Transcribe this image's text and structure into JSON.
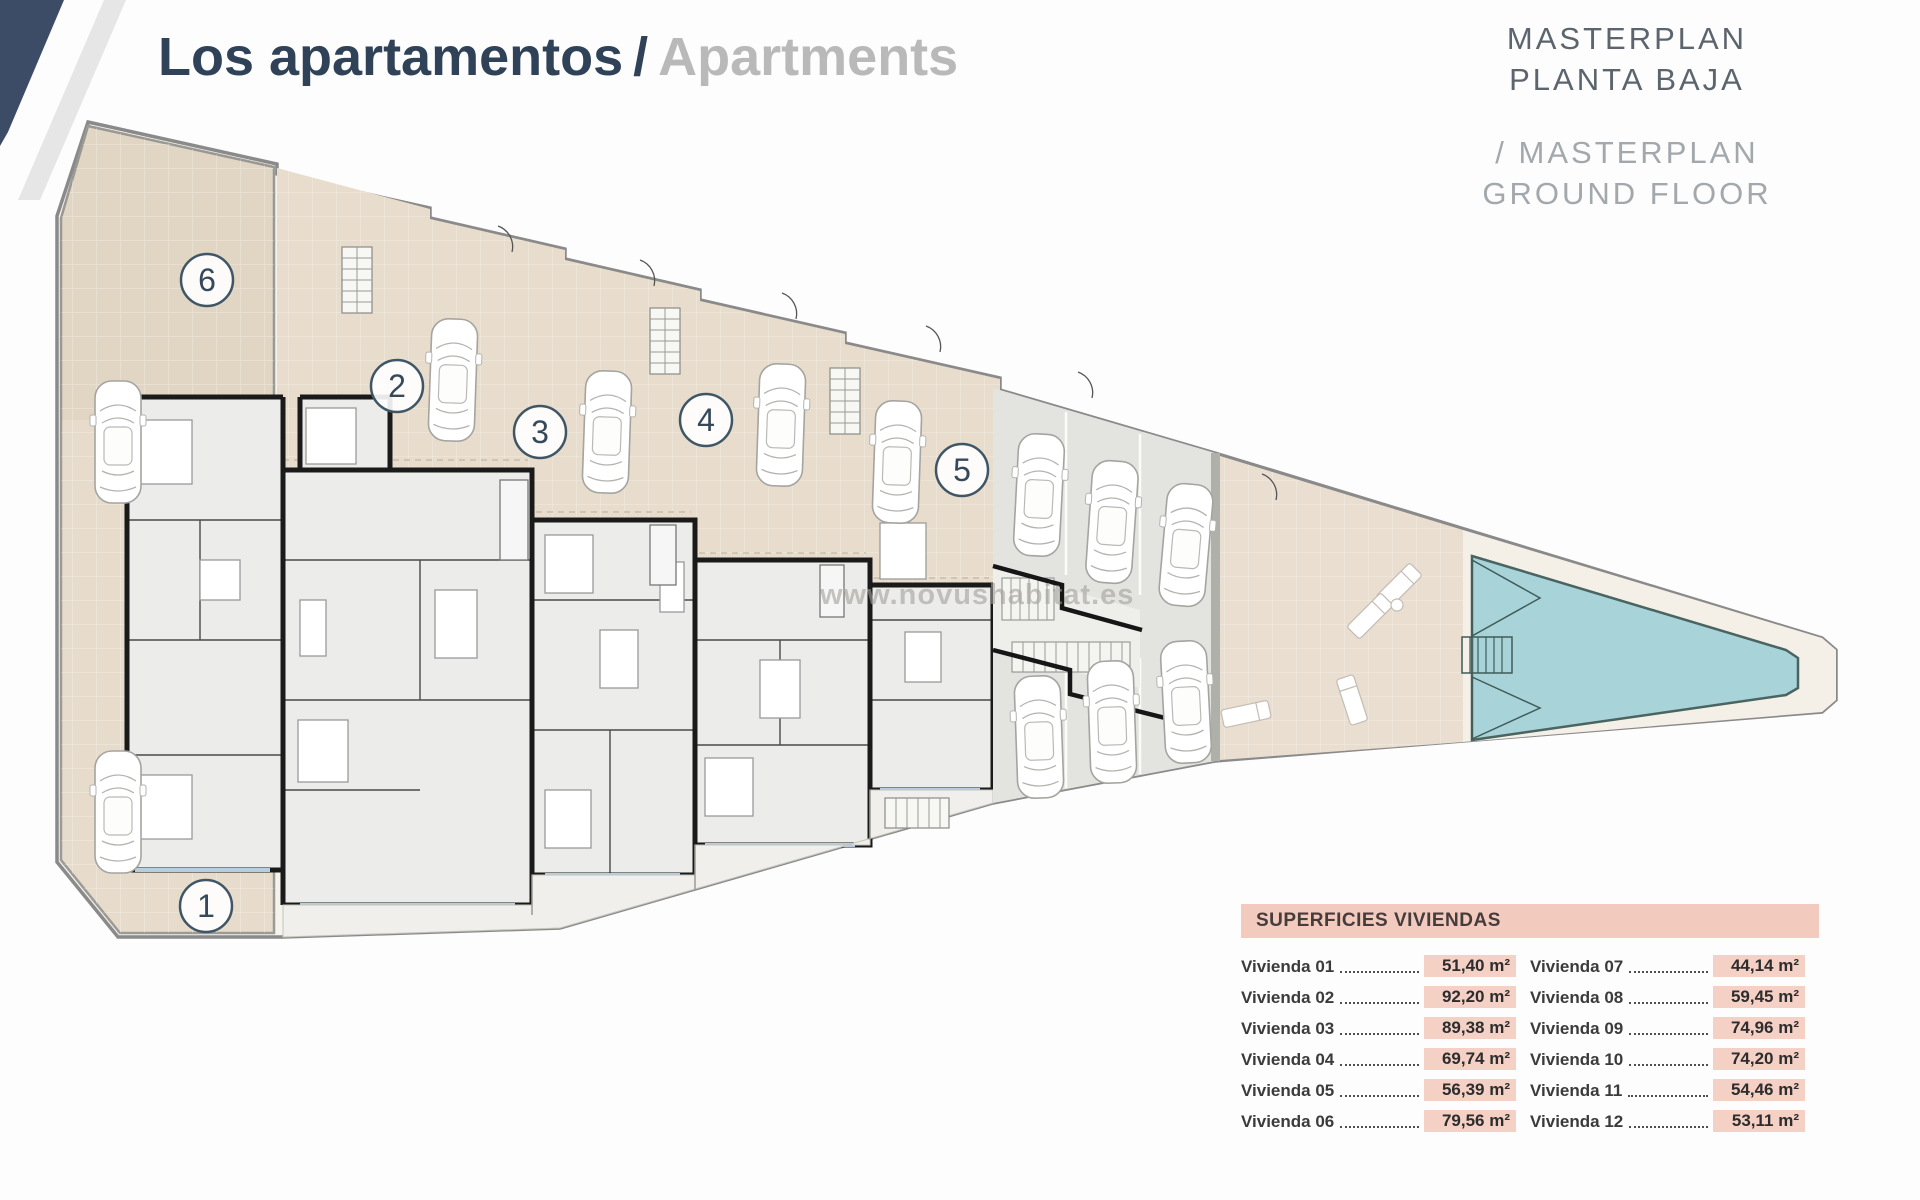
{
  "header": {
    "title_primary": "Los apartamentos",
    "title_separator": "/",
    "title_secondary": "Apartments"
  },
  "masterplan_caption": {
    "line1": "MASTERPLAN",
    "line2": "PLANTA BAJA",
    "line3": "/ MASTERPLAN",
    "line4": "GROUND FLOOR"
  },
  "watermark": "www.novushabitat.es",
  "plan": {
    "unit_markers": [
      {
        "number": "1"
      },
      {
        "number": "2"
      },
      {
        "number": "3"
      },
      {
        "number": "4"
      },
      {
        "number": "5"
      },
      {
        "number": "6"
      }
    ]
  },
  "areas_table": {
    "title": "SUPERFICIES VIVIENDAS",
    "columns": [
      {
        "rows": [
          {
            "label": "Vivienda 01",
            "value": "51,40 m²"
          },
          {
            "label": "Vivienda 02",
            "value": "92,20 m²"
          },
          {
            "label": "Vivienda 03",
            "value": "89,38 m²"
          },
          {
            "label": "Vivienda 04",
            "value": "69,74 m²"
          },
          {
            "label": "Vivienda 05",
            "value": "56,39 m²"
          },
          {
            "label": "Vivienda 06",
            "value": "79,56 m²"
          }
        ]
      },
      {
        "rows": [
          {
            "label": "Vivienda 07",
            "value": "44,14 m²"
          },
          {
            "label": "Vivienda 08",
            "value": "59,45 m²"
          },
          {
            "label": "Vivienda 09",
            "value": "74,96 m²"
          },
          {
            "label": "Vivienda 10",
            "value": "74,20 m²"
          },
          {
            "label": "Vivienda 11",
            "value": "54,46 m²"
          },
          {
            "label": "Vivienda 12",
            "value": "53,11 m²"
          }
        ]
      }
    ]
  },
  "colors": {
    "accent_navy": "#3d4c66",
    "title_navy": "#2f4257",
    "muted_gray": "#b9b9b9",
    "caption_gray": "#5c656d",
    "caption_light_gray": "#a3a8ac",
    "table_pink": "#f2cabe",
    "plan_beige": "#e7dccb",
    "pool_teal": "#a8d3d8"
  }
}
